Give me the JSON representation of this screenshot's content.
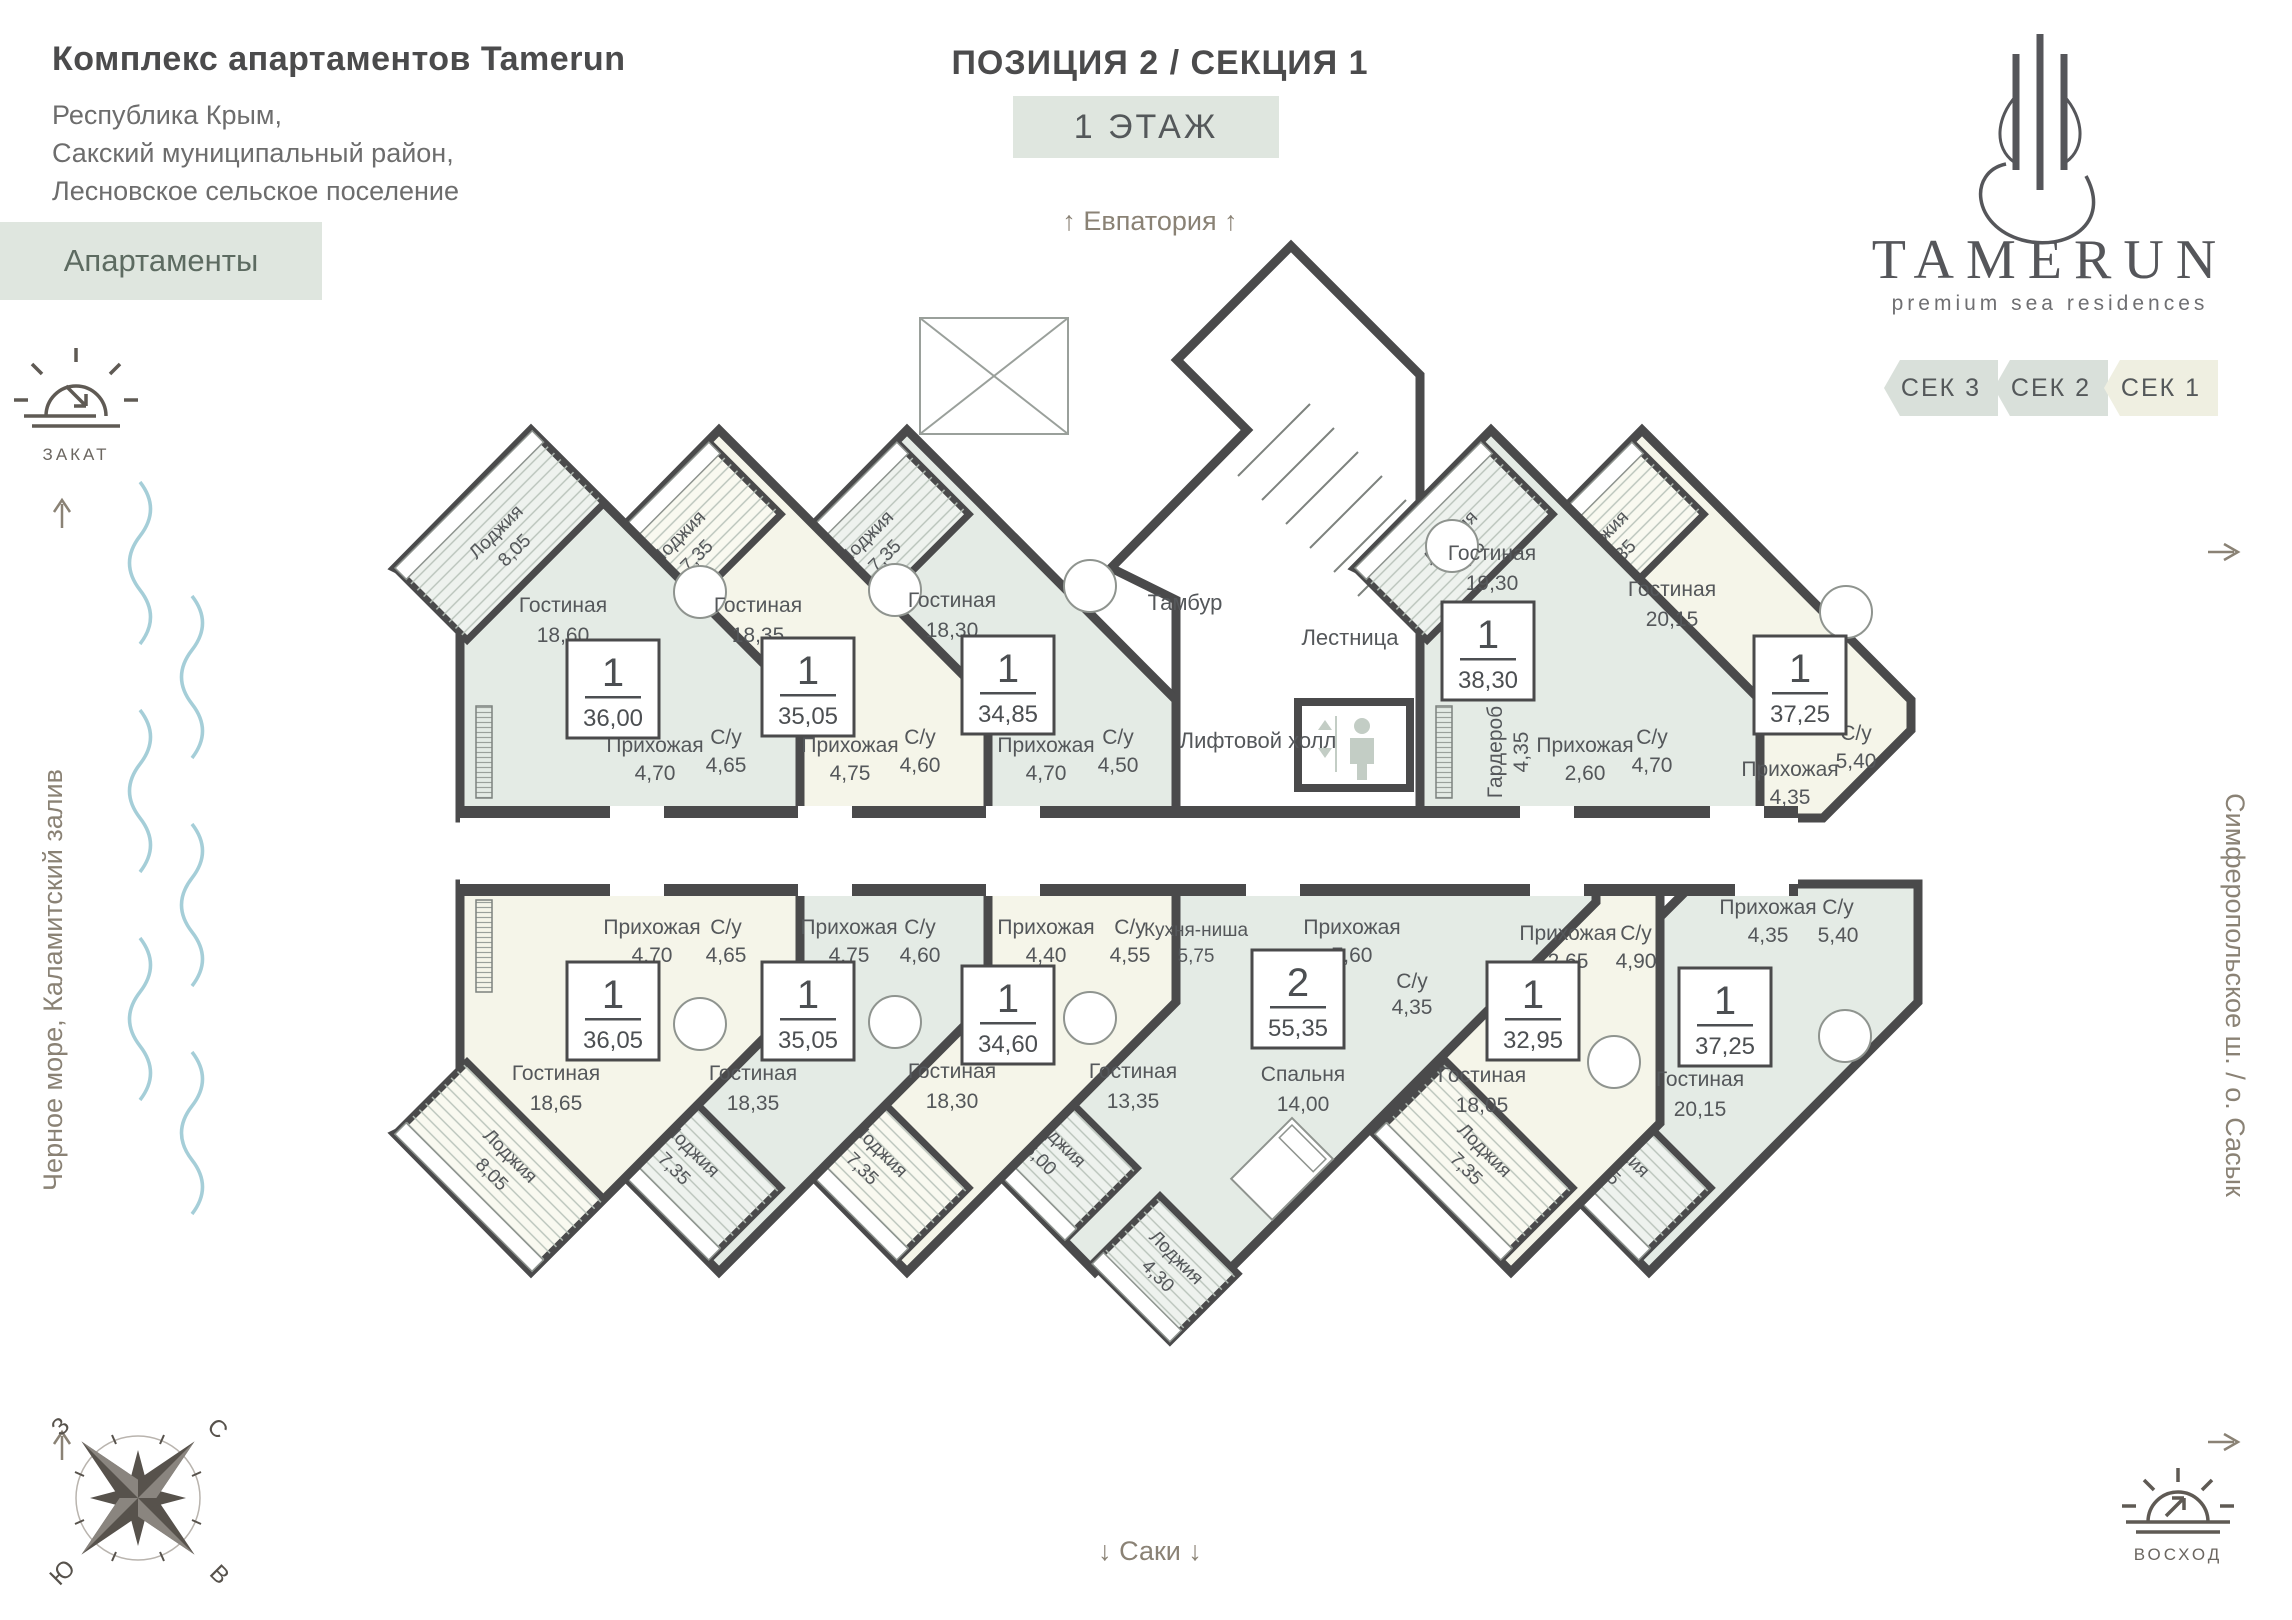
{
  "header": {
    "title": "Комплекс апартаментов Tamerun",
    "address": [
      "Республика Крым,",
      "Сакский муниципальный район,",
      "Лесновское сельское поселение"
    ],
    "type_badge": "Апартаменты",
    "position_title": "ПОЗИЦИЯ 2 / СЕКЦИЯ 1",
    "floor_badge": "1 ЭТАЖ"
  },
  "brand": {
    "logo": "TAMERUN",
    "tagline": "premium sea residences"
  },
  "tabs": [
    {
      "label": "СЕК 3"
    },
    {
      "label": "СЕК 2"
    },
    {
      "label": "СЕК 1"
    }
  ],
  "directions": {
    "top": "Евпатория",
    "bottom": "Саки",
    "left": "Черное море, Каламитский залив",
    "right": "Симферопольское ш. / о. Сасык",
    "sunset": "ЗАКАТ",
    "sunrise": "ВОСХОД"
  },
  "compass": {
    "n": "С",
    "s": "Ю",
    "w": "З",
    "e": "В"
  },
  "core": {
    "vestibule": "Тамбур",
    "stairs": "Лестница",
    "elevator_hall": "Лифтовой холл"
  },
  "apartments": [
    {
      "id": "t1",
      "type": "1",
      "total": "36,00",
      "rooms": {
        "loggia": {
          "name": "Лоджия",
          "area": "8,05"
        },
        "living": {
          "name": "Гостиная",
          "area": "18,60"
        },
        "hall": {
          "name": "Прихожая",
          "area": "4,70"
        },
        "bath": {
          "name": "С/у",
          "area": "4,65"
        }
      }
    },
    {
      "id": "t2",
      "type": "1",
      "total": "35,05",
      "rooms": {
        "loggia": {
          "name": "Лоджия",
          "area": "7,35"
        },
        "living": {
          "name": "Гостиная",
          "area": "18,35"
        },
        "hall": {
          "name": "Прихожая",
          "area": "4,75"
        },
        "bath": {
          "name": "С/у",
          "area": "4,60"
        }
      }
    },
    {
      "id": "t3",
      "type": "1",
      "total": "34,85",
      "rooms": {
        "loggia": {
          "name": "Лоджия",
          "area": "7,35"
        },
        "living": {
          "name": "Гостиная",
          "area": "18,30"
        },
        "hall": {
          "name": "Прихожая",
          "area": "4,70"
        },
        "bath": {
          "name": "С/у",
          "area": "4,50"
        }
      }
    },
    {
      "id": "t4",
      "type": "1",
      "total": "38,30",
      "rooms": {
        "loggia": {
          "name": "Лоджия",
          "area": "7,35"
        },
        "living": {
          "name": "Гостиная",
          "area": "19,30"
        },
        "wardrobe": {
          "name": "Гардероб",
          "area": "4,35"
        },
        "hall": {
          "name": "Прихожая",
          "area": "2,60"
        },
        "bath": {
          "name": "С/у",
          "area": "4,70"
        }
      }
    },
    {
      "id": "t5",
      "type": "1",
      "total": "37,25",
      "rooms": {
        "loggia": {
          "name": "Лоджия",
          "area": "7,35"
        },
        "living": {
          "name": "Гостиная",
          "area": "20,15"
        },
        "hall": {
          "name": "Прихожая",
          "area": "4,35"
        },
        "bath": {
          "name": "С/у",
          "area": "5,40"
        }
      }
    },
    {
      "id": "b1",
      "type": "1",
      "total": "36,05",
      "rooms": {
        "hall": {
          "name": "Прихожая",
          "area": "4,70"
        },
        "bath": {
          "name": "С/у",
          "area": "4,65"
        },
        "living": {
          "name": "Гостиная",
          "area": "18,65"
        },
        "loggia": {
          "name": "Лоджия",
          "area": "8,05"
        }
      }
    },
    {
      "id": "b2",
      "type": "1",
      "total": "35,05",
      "rooms": {
        "hall": {
          "name": "Прихожая",
          "area": "4,75"
        },
        "bath": {
          "name": "С/у",
          "area": "4,60"
        },
        "living": {
          "name": "Гостиная",
          "area": "18,35"
        },
        "loggia": {
          "name": "Лоджия",
          "area": "7,35"
        }
      }
    },
    {
      "id": "b3",
      "type": "1",
      "total": "34,60",
      "rooms": {
        "hall": {
          "name": "Прихожая",
          "area": "4,40"
        },
        "bath": {
          "name": "С/у",
          "area": "4,55"
        },
        "living": {
          "name": "Гостиная",
          "area": "18,30"
        },
        "loggia": {
          "name": "Лоджия",
          "area": "7,35"
        }
      }
    },
    {
      "id": "b4",
      "type": "2",
      "total": "55,35",
      "rooms": {
        "kitchen": {
          "name": "Кухня-ниша",
          "area": "5,75"
        },
        "hall": {
          "name": "Прихожая",
          "area": "7,60"
        },
        "bath": {
          "name": "С/у",
          "area": "4,35"
        },
        "living": {
          "name": "Гостиная",
          "area": "13,35"
        },
        "bedroom": {
          "name": "Спальня",
          "area": "14,00"
        },
        "loggia": {
          "name": "Лоджия",
          "area": "6,00"
        },
        "loggia2": {
          "name": "Лоджия",
          "area": "4,30"
        }
      }
    },
    {
      "id": "b5",
      "type": "1",
      "total": "32,95",
      "rooms": {
        "hall": {
          "name": "Прихожая",
          "area": "2,65"
        },
        "bath": {
          "name": "С/у",
          "area": "4,90"
        },
        "living": {
          "name": "Гостиная",
          "area": "18,05"
        },
        "loggia": {
          "name": "Лоджия",
          "area": "7,35"
        }
      }
    },
    {
      "id": "b6",
      "type": "1",
      "total": "37,25",
      "rooms": {
        "hall": {
          "name": "Прихожая",
          "area": "4,35"
        },
        "bath": {
          "name": "С/у",
          "area": "5,40"
        },
        "living": {
          "name": "Гостиная",
          "area": "20,15"
        },
        "loggia": {
          "name": "Лоджия",
          "area": "7,35"
        }
      }
    }
  ]
}
